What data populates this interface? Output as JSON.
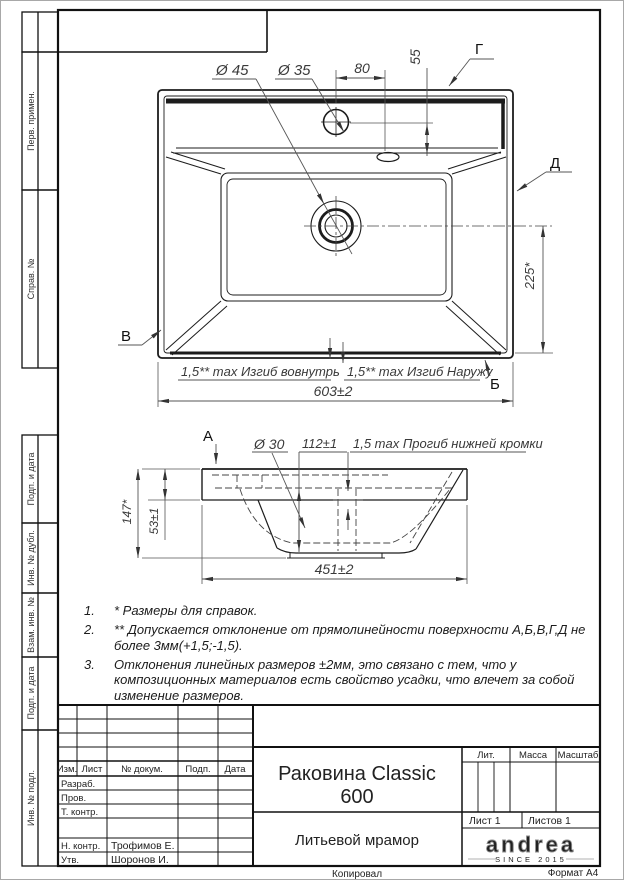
{
  "left_strip": {
    "sections": [
      "Перв. примен.",
      "Справ. №",
      "Подп. и дата",
      "Инв. № дубл.",
      "Взам. инв. №",
      "Подп. и дата",
      "Инв. № подл."
    ]
  },
  "top_view": {
    "d45": "Ø 45",
    "d35": "Ø 35",
    "dim80": "80",
    "dim55": "55",
    "dim225": "225*",
    "dim603": "603±2",
    "label_g": "Г",
    "label_d": "Д",
    "label_v": "В",
    "label_b": "Б",
    "bend_in": "1,5** max Изгиб вовнутрь",
    "bend_out": "1,5** max Изгиб Наружу"
  },
  "section_view": {
    "label_a": "А",
    "d30": "Ø 30",
    "dim112": "112±1",
    "sag": "1,5 max Прогиб нижней кромки",
    "dim147": "147*",
    "dim53": "53±1",
    "dim451": "451±2"
  },
  "notes": [
    {
      "num": "1.",
      "text": "* Размеры для справок."
    },
    {
      "num": "2.",
      "text": "** Допускается отклонение от прямолинейности поверхности А,Б,В,Г,Д не более 3мм(+1,5;-1,5)."
    },
    {
      "num": "3.",
      "text": "Отклонения линейных размеров ±2мм, это связано с тем, что у композиционных материалов есть свойство усадки, что влечет за собой изменение размеров."
    }
  ],
  "title_block": {
    "cols": {
      "izm": "Изм.",
      "list": "Лист",
      "doc": "№ докум.",
      "podp": "Подп.",
      "data": "Дата"
    },
    "roles": {
      "razrab": "Разраб.",
      "prov": "Пров.",
      "tkontr": "Т. контр.",
      "nkontr": "Н. контр.",
      "utv": "Утв."
    },
    "names": {
      "nkontr": "Трофимов Е.",
      "utv": "Шоронов И."
    },
    "title_line1": "Раковина Classic",
    "title_line2": "600",
    "material": "Литьевой мрамор",
    "lit": "Лит.",
    "massa": "Масса",
    "masshtab": "Масштаб",
    "sheet": "Лист 1",
    "sheets": "Листов 1",
    "logo": "andrea",
    "logo_sub": "SINCE 2015",
    "copied": "Копировал",
    "format": "Формат А4"
  }
}
